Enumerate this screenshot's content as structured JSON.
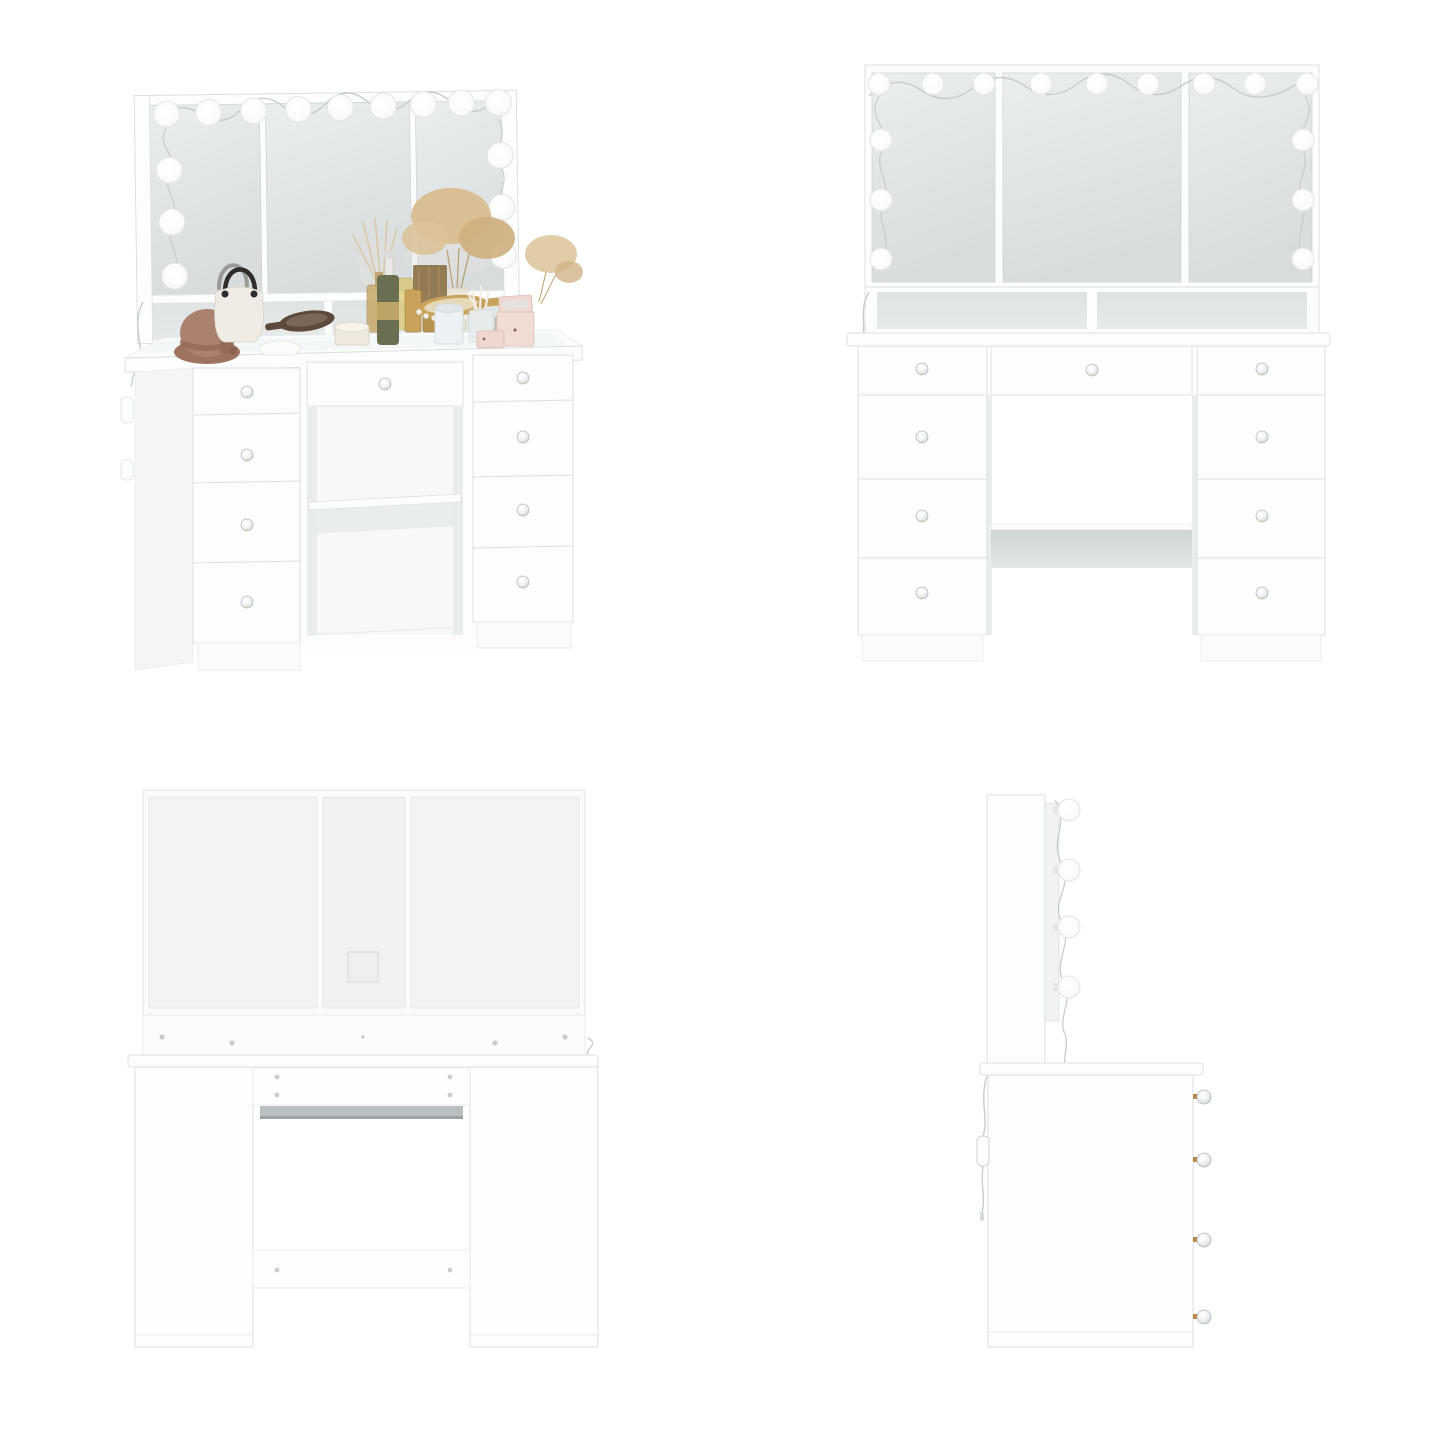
{
  "product_image": {
    "type": "furniture-product-photo-grid",
    "subject": "white vanity dressing table with hollywood lighted tri-fold mirror and 9 drawers",
    "views": [
      {
        "id": "perspective",
        "position": "top-left",
        "bulbs_top_row": 9,
        "bulbs_left_column": 3,
        "bulbs_right_column": 3,
        "drawers_left": 4,
        "drawers_center": 1,
        "drawers_right": 4,
        "has_props": true
      },
      {
        "id": "front",
        "position": "top-right",
        "bulbs_top_row": 9,
        "bulbs_left_column": 3,
        "bulbs_right_column": 3,
        "drawers_left": 4,
        "drawers_center": 1,
        "drawers_right": 4,
        "has_props": false
      },
      {
        "id": "back",
        "position": "bottom-left",
        "cutout_square": 1,
        "rail_screws": 5,
        "opening_top_screws": 4,
        "shelf_back_screws": 2
      },
      {
        "id": "side",
        "position": "bottom-right",
        "bulbs_visible": 4,
        "knobs_visible": 4,
        "power_cord_switch": 1
      }
    ],
    "props_on_desk": [
      "cloche-hat",
      "handbag",
      "white-cloth",
      "wooden-hand-mirror",
      "powder-box",
      "green-dropper-bottle",
      "gold-cosmetic-set",
      "gold-hand-mirror",
      "pearl-necklace",
      "reed-diffuser",
      "dried-flowers",
      "candle",
      "cotton-swab-cup",
      "smoked-glass-jar",
      "pink-jewelry-box",
      "pink-gift-box"
    ]
  },
  "colors": {
    "bg": "#ffffff",
    "furniture": "#fdfdfe",
    "furniture-shade": "#f4f6f6",
    "line": "#dcdfe0",
    "line-soft": "#e8ebec",
    "mirror-top": "#ebeeee",
    "mirror-bottom": "#d8dcdc",
    "cubby": "#e7eaea",
    "panel-back": "#f2f4f4",
    "shelf-gray": "#cfd4d5",
    "shadow": "#e6e9e9",
    "bulb": "#ffffff",
    "bulb-edge": "#e3e6e6",
    "wire": "#c8cccd",
    "knob-edge": "#b6bcbf",
    "brass": "#b98a44",
    "hat": "#ab8170",
    "hat-dark": "#946a58",
    "bag": "#f0ebe4",
    "bag-handle": "#2e2c2a",
    "wood-dark": "#5d4a3c",
    "cream": "#efe8df",
    "olive": "#6a6f52",
    "gold": "#c9a25c",
    "gold-light": "#e7d9b8",
    "amber": "#c9a86a",
    "flower-tan": "#d9bd90",
    "candle-glass": "#eef1f3",
    "pink-box": "#f2ddd5",
    "pearl": "#f3efe8"
  }
}
